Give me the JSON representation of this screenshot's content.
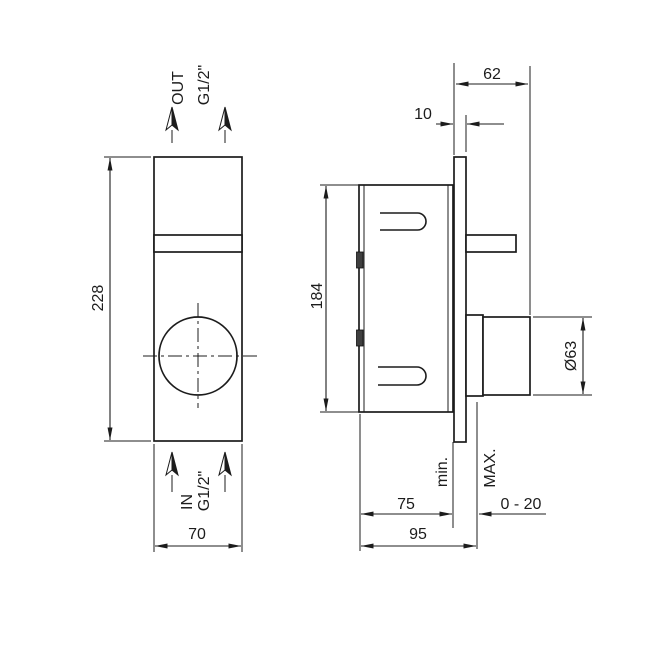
{
  "drawing": {
    "front_view": {
      "out_label": "OUT",
      "out_thread": "G1/2\"",
      "in_label": "IN",
      "in_thread": "G1/2\"",
      "dim_height": "228",
      "dim_width": "70"
    },
    "side_view": {
      "dim_projection": "62",
      "dim_plate_thickness": "10",
      "dim_body_height": "184",
      "dim_knob_diameter": "Ø63",
      "label_min": "min.",
      "label_max": "MAX.",
      "dim_depth_min": "75",
      "dim_depth_max": "95",
      "dim_wall_range": "0 - 20"
    }
  }
}
